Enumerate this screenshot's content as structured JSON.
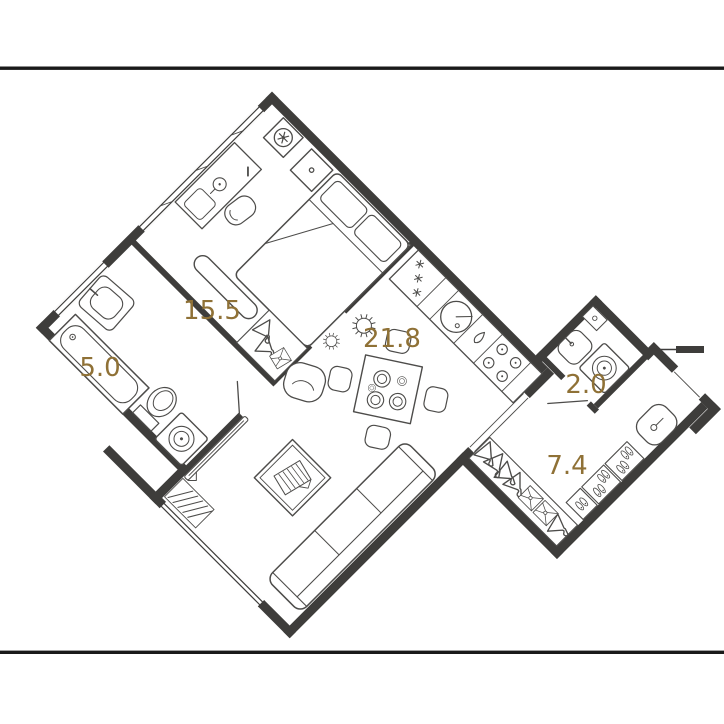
{
  "meta": {
    "type": "floor-plan",
    "description": "One-bedroom apartment floor plan rotated 45 degrees between two horizontal frame lines",
    "rotation_deg": 45
  },
  "colors": {
    "background": "#ffffff",
    "walls": "#3e3d3b",
    "furniture_outline": "#4d4c4a",
    "area_labels": "#8f7136",
    "frame_lines": "#1a1a1a"
  },
  "rooms": [
    {
      "id": "bedroom",
      "area_label": "15.5",
      "features": [
        "double-bed",
        "two-pillows",
        "nightstand",
        "bed-bench",
        "desk",
        "desk-lamp",
        "desk-chair",
        "built-in-wardrobe-hangers",
        "supply-ventilation-fan",
        "window-band"
      ]
    },
    {
      "id": "bathroom",
      "area_label": "5.0",
      "features": [
        "bathtub",
        "washbasin",
        "toilet",
        "washing-machine",
        "window-band",
        "door"
      ]
    },
    {
      "id": "kitchen-living-room",
      "area_label": "21.8",
      "features": [
        "refrigerator-with-freezer-stars",
        "round-kitchen-sink",
        "kettle",
        "cooktop-4-burner",
        "dining-table-with-4-chairs-and-plates",
        "sofa-3-seat",
        "coffee-table-with-magazines",
        "tv",
        "radiator",
        "two-ceiling-lights",
        "supply-ventilation-fan",
        "window-band"
      ]
    },
    {
      "id": "wc",
      "area_label": "2.0",
      "features": [
        "washbasin",
        "washing-machine",
        "shelf",
        "door-leaf"
      ]
    },
    {
      "id": "hallway",
      "area_label": "7.4",
      "features": [
        "open-wardrobe-with-hangers",
        "folded-clothes-boxes",
        "shoe-racks",
        "pouf",
        "entrance-opening"
      ]
    }
  ]
}
